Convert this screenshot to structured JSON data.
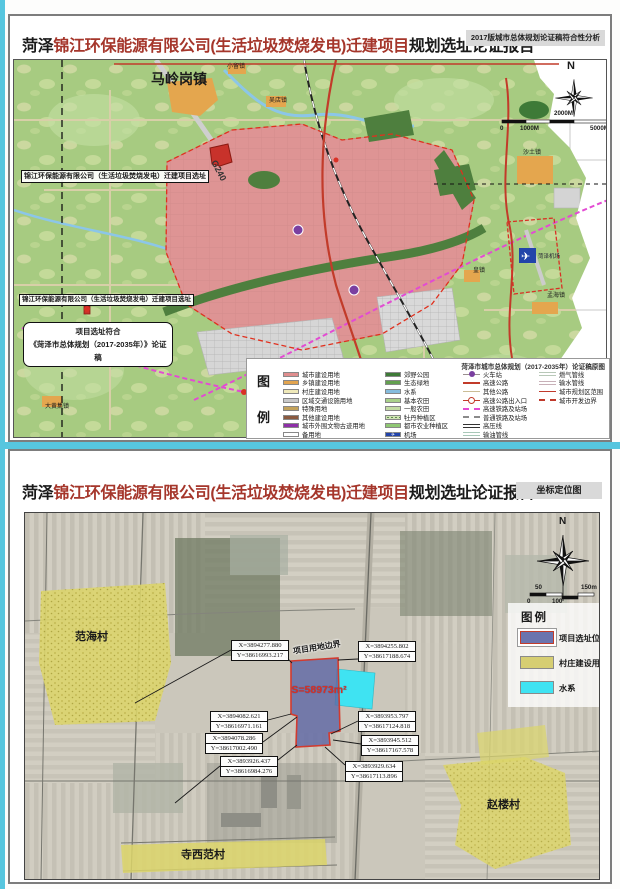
{
  "theme": {
    "accent_strip": "#57C6DF",
    "panel_border": "#7d7d7d",
    "title_red": "#A5362B",
    "badge_bg": "#D9D9D9",
    "site_fill": "#5F68A5",
    "site_border": "#D23B2F",
    "water": "#3FE3F2",
    "village_fill": "#DCD56A",
    "city_pink": "#DE9494",
    "land_green": "#A7CB81"
  },
  "top_panel": {
    "title": {
      "prefix": "菏泽",
      "highlight": "锦江环保能源有限公司(生活垃圾焚烧发电)迁建项目",
      "suffix": "规划选址论证报告"
    },
    "badge": "2017版城市总体规划论证稿符合性分析",
    "map": {
      "compass": "N",
      "scale": {
        "above": "2000M",
        "zero": "0",
        "mid": "1000M",
        "end": "5000M"
      },
      "towns": {
        "maling": "马岭岗镇",
        "xiaoliu": "小留镇",
        "wudian": "吴店镇",
        "shatu": "沙土镇",
        "huang": "皇镇",
        "menghai": "孟海镇",
        "wanghaotun": "王浩屯镇",
        "dahuangji": "大黄集镇",
        "airport": "菏泽机场"
      },
      "road_g240": "G240",
      "site_label_top": "锦江环保能源有限公司（生活垃圾焚烧发电）迁建项目选址",
      "site_label_mid": "锦江环保能源有限公司（生活垃圾焚烧发电）迁建项目选址",
      "callout": {
        "line1": "项目选址符合",
        "line2": "《菏泽市总体规划（2017-2035年）》论证稿"
      }
    },
    "legend": {
      "caption_top": "图",
      "caption_bottom": "例",
      "title": "菏泽市城市总体规划（2017-2035年）论证稿原图",
      "airport_icon": "✈",
      "col1": [
        {
          "label": "城市建设用地",
          "color": "#E08E8E"
        },
        {
          "label": "乡镇建设用地",
          "color": "#E2A44F"
        },
        {
          "label": "村庄建设用地",
          "color": "#EFE9B9"
        },
        {
          "label": "区域交通设施用地",
          "color": "#C9C9C9"
        },
        {
          "label": "特殊用地",
          "color": "#C3A25A"
        },
        {
          "label": "其他建设用地",
          "color": "#8A5A40"
        },
        {
          "label": "城市外围文物古迹用地",
          "color": "#8E2FA8"
        },
        {
          "label": "备用地",
          "color": "#FFFFFF"
        }
      ],
      "col2": [
        {
          "label": "郊野公园",
          "color": "#3E7A37"
        },
        {
          "label": "生态绿地",
          "color": "#63A04F"
        },
        {
          "label": "水系",
          "color": "#85BCDD"
        },
        {
          "label": "基本农田",
          "color": "#A9D189"
        },
        {
          "label": "一般农田",
          "color": "#C2DCA2"
        },
        {
          "label": "牡丹种植区",
          "color": "#CFE4B4"
        },
        {
          "label": "都市农业种植区",
          "color": "#8FC773"
        },
        {
          "label": "机场",
          "color": "#2244AA"
        }
      ],
      "col3": [
        {
          "label": "火车站",
          "color": "#7A3FA0"
        },
        {
          "label": "高速公路",
          "color": "#C23B2A"
        },
        {
          "label": "其他公路",
          "color": "#CBBD96"
        },
        {
          "label": "高速公路出入口",
          "color": "#C23B2A"
        },
        {
          "label": "高速铁路及站场",
          "color": "#E34BD3"
        },
        {
          "label": "普通铁路及站场",
          "color": "#8A8A8A"
        },
        {
          "label": "高压线",
          "color": "#333333"
        },
        {
          "label": "输油管线",
          "color": "#A8C8B8"
        }
      ],
      "col4": [
        {
          "label": "燃气管线",
          "color": "#B8C8B8"
        },
        {
          "label": "输水管线",
          "color": "#C8B0B8"
        },
        {
          "label": "城市规划区范围",
          "color": "#C0392B"
        },
        {
          "label": "城市开发边界",
          "color": "#C0392B"
        }
      ]
    }
  },
  "bottom_panel": {
    "title": {
      "prefix": "菏泽",
      "highlight": "锦江环保能源有限公司(生活垃圾焚烧发电)迁建项目",
      "suffix": "规划选址论证报告"
    },
    "badge": "坐标定位图",
    "map": {
      "compass": "N",
      "villages": {
        "fanhai": "范海村",
        "zhaolou": "赵楼村",
        "sixifan": "寺西范村"
      },
      "boundary_label": "项目用地边界",
      "area_label": "S=58973m²",
      "coords": [
        {
          "x": "X=3894277.880",
          "y": "Y=38616993.217"
        },
        {
          "x": "X=3894255.802",
          "y": "Y=38617188.674"
        },
        {
          "x": "X=3894082.621",
          "y": "Y=38616971.161"
        },
        {
          "x": "X=3894078.286",
          "y": "Y=38617002.490"
        },
        {
          "x": "X=3893926.437",
          "y": "Y=38616984.276"
        },
        {
          "x": "X=3893953.797",
          "y": "Y=38617124.818"
        },
        {
          "x": "X=3893945.512",
          "y": "Y=38617167.578"
        },
        {
          "x": "X=3893929.634",
          "y": "Y=38617113.896"
        }
      ],
      "scale": {
        "t50": "50",
        "t150": "150m",
        "t0": "0",
        "t100": "100"
      }
    },
    "legend": {
      "caption": "图例",
      "items": [
        {
          "label": "项目选址位置",
          "color": "#6B74AE"
        },
        {
          "label": "村庄建设用地",
          "color": "#D6CE72"
        },
        {
          "label": "水系",
          "color": "#3FE3F2"
        }
      ]
    }
  }
}
